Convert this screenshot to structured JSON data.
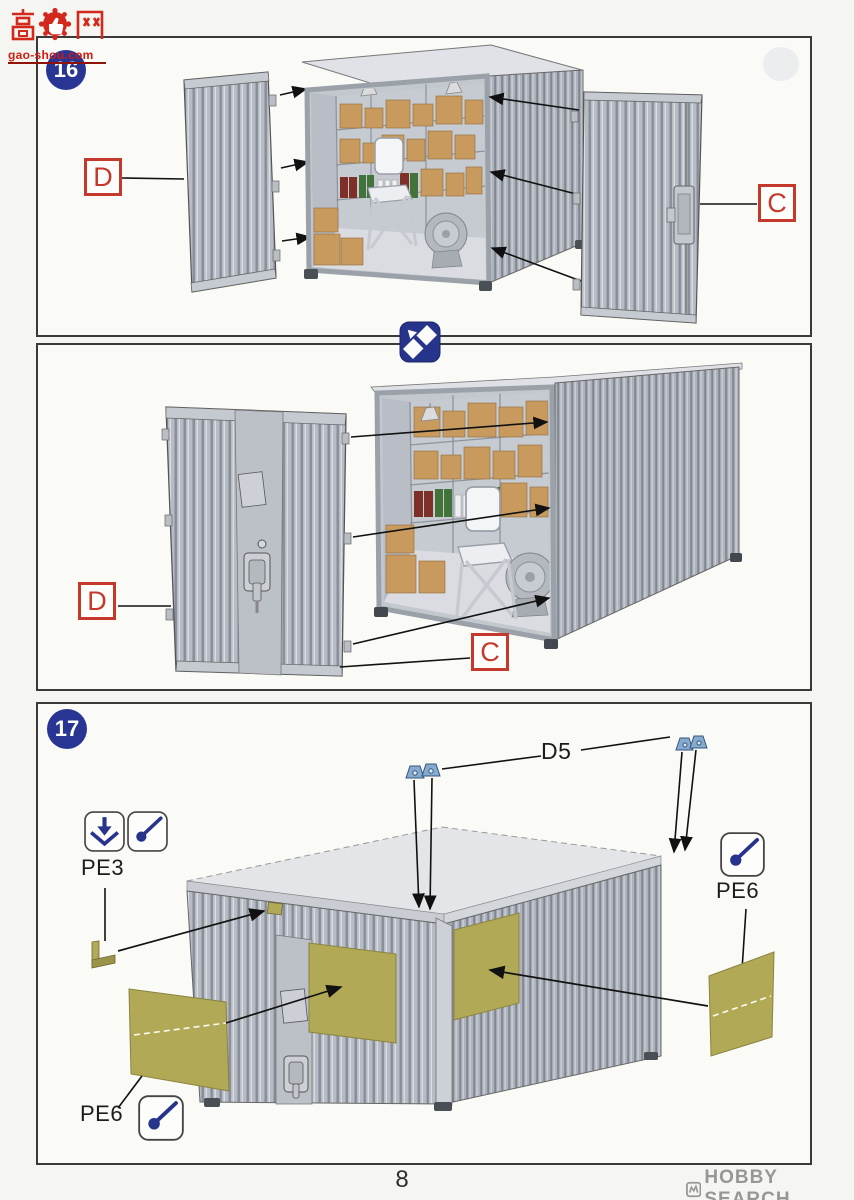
{
  "page": {
    "number": "8",
    "site_watermark": {
      "name": "高手网",
      "domain": "gao-shou.com"
    },
    "shop_watermark": "HOBBY SEARCH"
  },
  "step16": {
    "number": "16",
    "view1": {
      "left_door_label": "D",
      "right_door_label": "C"
    },
    "view2": {
      "left_door_label": "D",
      "right_door_label": "C"
    }
  },
  "step17": {
    "number": "17",
    "labels": {
      "corner_fittings": "D5",
      "bracket": "PE3",
      "panel_right": "PE6",
      "panel_left": "PE6"
    }
  },
  "icons": {
    "rotate": "rotate-view",
    "bend": "fold-pe-part",
    "glue": "apply-glue"
  },
  "colors": {
    "badge_blue": "#283593",
    "label_red": "#c5392c",
    "pe_olive": "#b1a955",
    "part_blue": "#87abce"
  }
}
